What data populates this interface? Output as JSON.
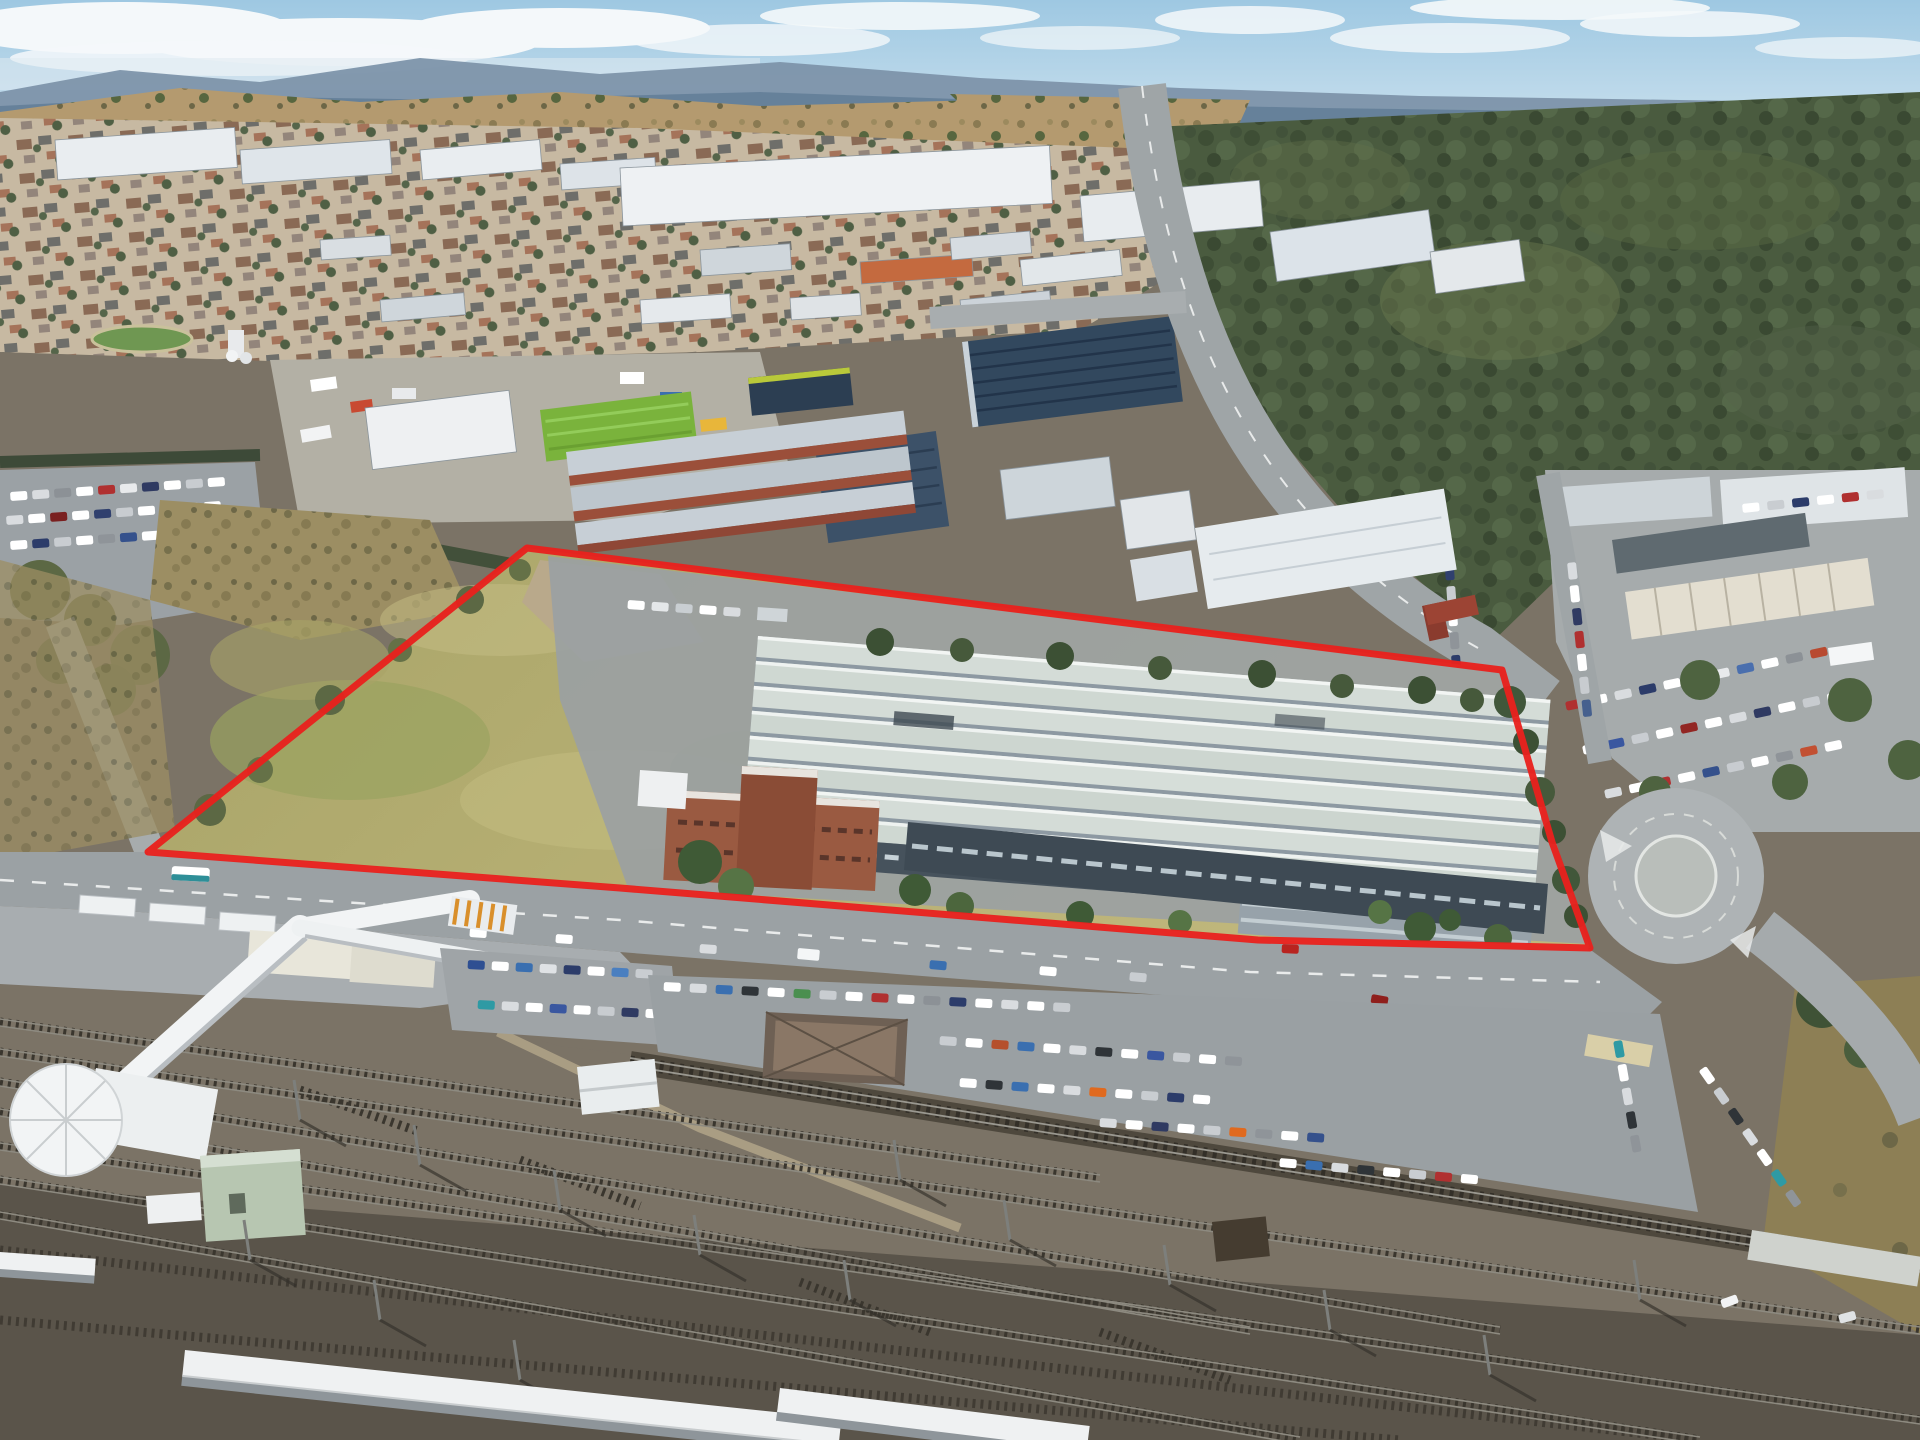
{
  "image": {
    "kind": "aerial-drone-photograph",
    "subject": "industrial development site outlined in red beside a railway station and rail corridor, with industrial suburb, bushland and hills behind",
    "width_px": 1920,
    "height_px": 1440
  },
  "boundary": {
    "color": "#e8211d",
    "stroke_width": 7,
    "points_svg": "148,852 527,548 1502,670 1552,842 1590,948 1258,940 620,888"
  },
  "palette": {
    "sky_top": "#9ec8e2",
    "sky_bottom": "#cfe3ef",
    "clouds": "#f4f8fa",
    "mountains": "#7d93aa",
    "mountains_dark": "#5e7a94",
    "hills": "#b49a6f",
    "bushland": "#4a5b3f",
    "suburb_ground": "#c7b9a2",
    "industrial_roof_white": "#ecf0f2",
    "solar_roof_navy": "#32485e",
    "lime_green_shed": "#7ab33c",
    "brick_red": "#9b4f3a",
    "site_grass": "#b5ae72",
    "asphalt": "#9aa0a3",
    "warehouse_roof_strip": "#d4dcd7",
    "warehouse_glazing": "#3e4a54",
    "office_brick": "#9a5a41",
    "rail_dirt": "#7b7366",
    "rail_ballast_dark": "#57514a",
    "platform_white": "#eff1f2",
    "grass_triangle": "#8d7f55",
    "red_line": "#e8211d"
  },
  "scene": {
    "regions": [
      {
        "name": "sky",
        "description": "pale blue sky with white cloud bands along the top edge"
      },
      {
        "name": "mountain-ridge",
        "description": "distant blue mountain range on the horizon"
      },
      {
        "name": "hills",
        "description": "dry tan hills with scattered trees behind the town"
      },
      {
        "name": "bushland-east",
        "description": "dense dark-green bushland on the right half of the frame"
      },
      {
        "name": "suburb",
        "description": "low-density housing area with mixed roof colours, upper left"
      },
      {
        "name": "industrial-north",
        "description": "industrial estate with white, grey, navy solar and lime-green warehouse roofs"
      },
      {
        "name": "main-road-north",
        "description": "arterial road running from the top of frame down to an intersection near the site"
      },
      {
        "name": "dealership-east",
        "description": "car yard with long workshop buildings and densely parked colourful cars"
      },
      {
        "name": "site",
        "description": "red-outlined development parcel: olive grass paddock on the west, large multi-span warehouse with pale roof strips and red-brick office on the east"
      },
      {
        "name": "frontage-road",
        "description": "road running along the southern site boundary with cars and a bus"
      },
      {
        "name": "roundabout",
        "description": "roundabout at the south-east corner of the site"
      },
      {
        "name": "station",
        "description": "railway station with white pedestrian footbridge, round access tower and platform canopies"
      },
      {
        "name": "car-parks",
        "description": "commuter car parks full of parked cars south of the frontage road"
      },
      {
        "name": "rail-corridor",
        "description": "wide rail corridor with many parallel tracks, catenary masts and platforms across the bottom of the frame"
      },
      {
        "name": "grass-triangle-southeast",
        "description": "brown grass triangle between the roundabout road and the rail line"
      },
      {
        "name": "red-boundary",
        "description": "bold red polygon outlining the property for sale"
      }
    ]
  }
}
